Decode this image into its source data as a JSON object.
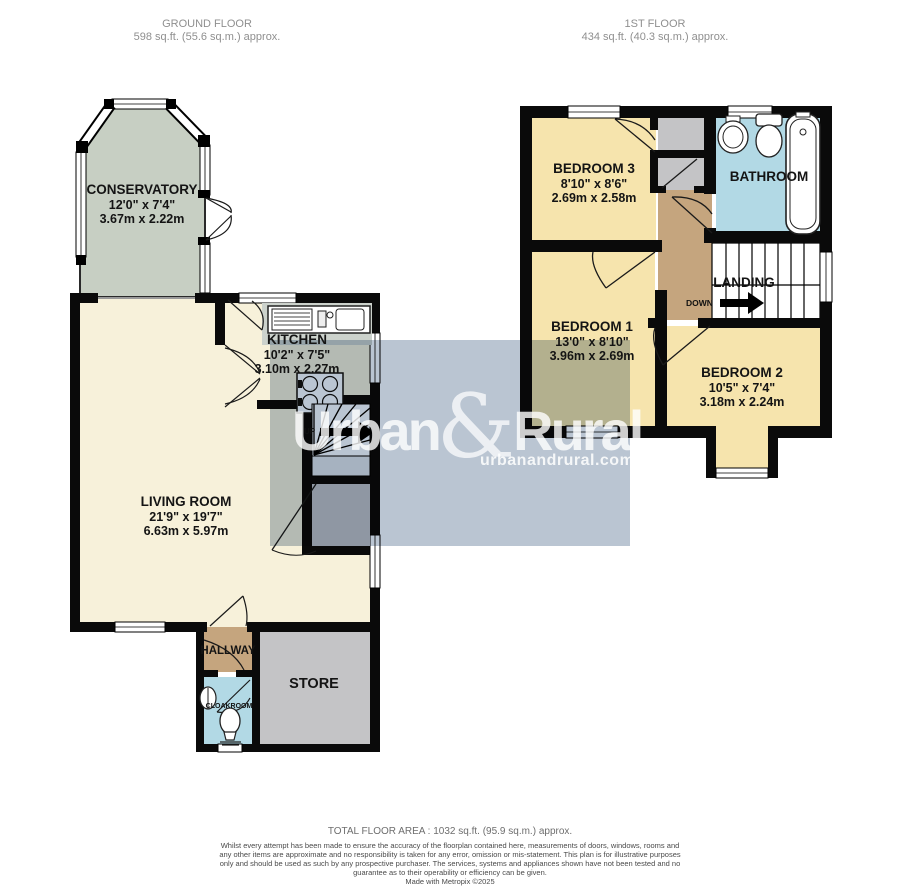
{
  "header": {
    "ground": {
      "title": "GROUND FLOOR",
      "area": "598 sq.ft. (55.6 sq.m.) approx."
    },
    "first": {
      "title": "1ST FLOOR",
      "area": "434 sq.ft. (40.3 sq.m.) approx."
    }
  },
  "rooms": {
    "conservatory": {
      "name": "CONSERVATORY",
      "imperial": "12'0\" x 7'4\"",
      "metric": "3.67m x 2.22m"
    },
    "kitchen": {
      "name": "KITCHEN",
      "imperial": "10'2\" x 7'5\"",
      "metric": "3.10m x 2.27m"
    },
    "living": {
      "name": "LIVING ROOM",
      "imperial": "21'9\" x 19'7\"",
      "metric": "6.63m x 5.97m"
    },
    "hallway": {
      "name": "HALLWAY"
    },
    "cloakroom": {
      "name": "CLOAKROOM"
    },
    "store": {
      "name": "STORE"
    },
    "bedroom3": {
      "name": "BEDROOM 3",
      "imperial": "8'10\" x 8'6\"",
      "metric": "2.69m x 2.58m"
    },
    "bathroom": {
      "name": "BATHROOM"
    },
    "bedroom1": {
      "name": "BEDROOM 1",
      "imperial": "13'0\" x 8'10\"",
      "metric": "3.96m x 2.69m"
    },
    "bedroom2": {
      "name": "BEDROOM 2",
      "imperial": "10'5\" x 7'4\"",
      "metric": "3.18m x 2.24m"
    },
    "landing": {
      "name": "LANDING"
    }
  },
  "stairs": {
    "up": "UP",
    "down": "DOWN"
  },
  "watermark": {
    "brand_first": "Urban",
    "brand_amp": "&",
    "brand_second": "Rural",
    "url": "urbanandrural.com"
  },
  "footer": {
    "total": "TOTAL FLOOR AREA : 1032 sq.ft. (95.9 sq.m.) approx.",
    "disclaimer": "Whilst every attempt has been made to ensure the accuracy of the floorplan contained here, measurements of doors, windows, rooms and any other items are approximate and no responsibility is taken for any error, omission or mis-statement. This plan is for illustrative purposes only and should be used as such by any prospective purchaser. The services, systems and appliances shown have not been tested and no guarantee as to their operability or efficiency can be given.",
    "credit": "Made with Metropix ©2025"
  },
  "colors": {
    "cream": "#f7f1da",
    "bedroom_yellow": "#f6e4ad",
    "conservatory_green": "#c7cfc3",
    "hall_tan": "#c5a57e",
    "wet_blue": "#b2d9e5",
    "store_gray": "#c4c4c6",
    "wall": "#0a0a0a",
    "watermark_band": "#b6c2d0"
  }
}
